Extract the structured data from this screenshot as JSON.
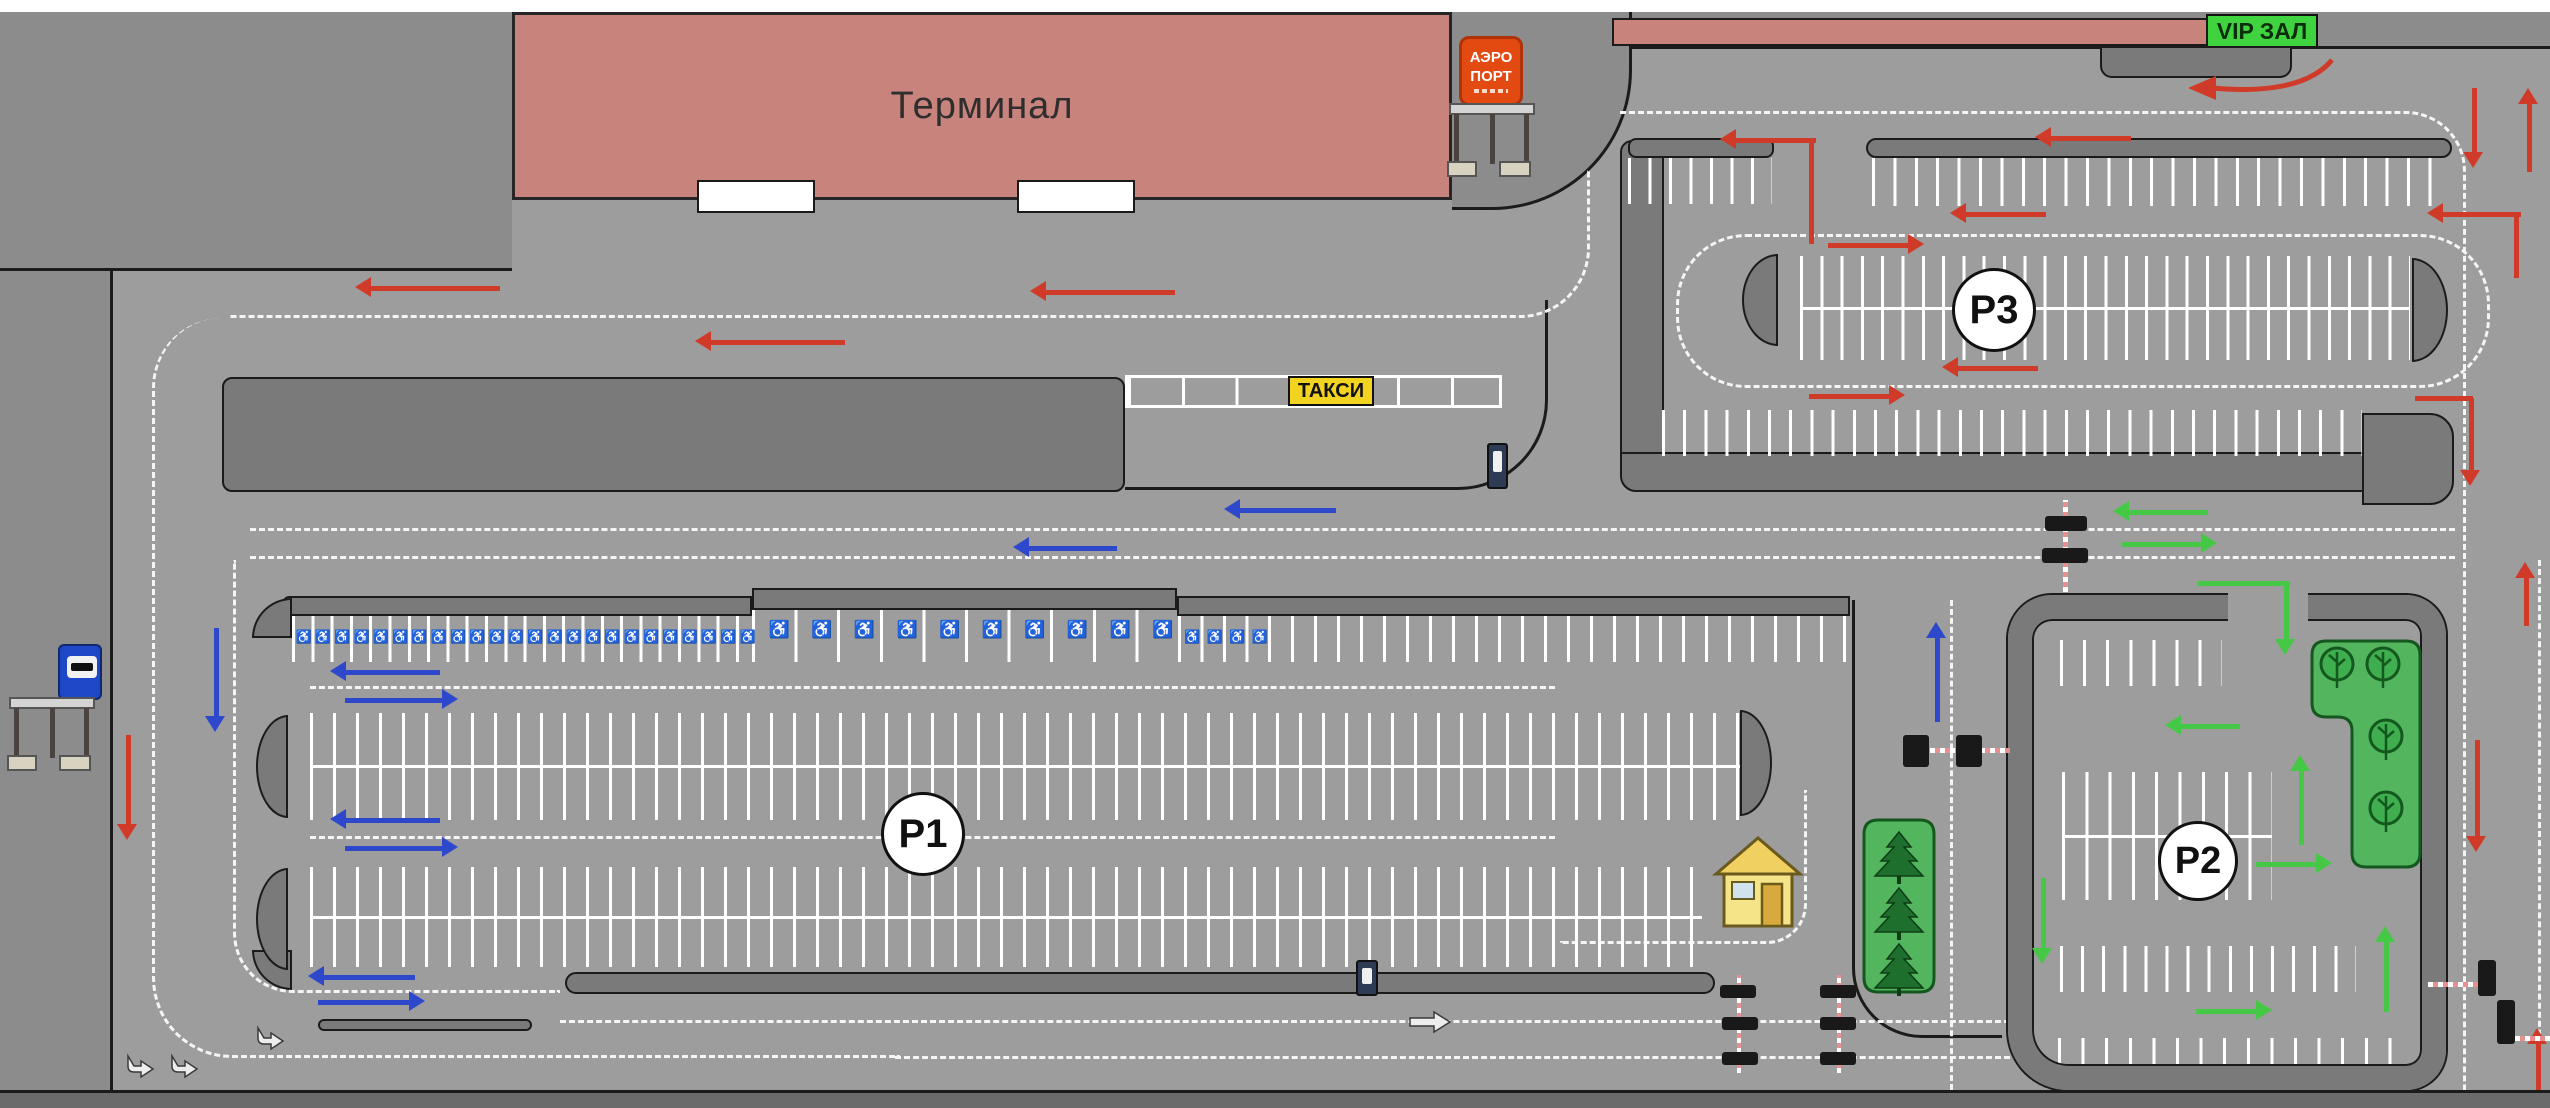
{
  "labels": {
    "terminal": "Терминал",
    "taxi": "ТАКСИ",
    "vip": "VIP ЗАЛ",
    "airport_line1": "АЭРО",
    "airport_line2": "ПОРТ",
    "p1": "P1",
    "p2": "P2",
    "p3": "P3"
  },
  "symbols": {
    "wheelchair": "♿"
  },
  "colors": {
    "pavement": "#9d9d9d",
    "margin": "#8c8c8c",
    "curb": "#7a7a7a",
    "band": "#6b6b6b",
    "white": "#ffffff",
    "building": "#c9837d",
    "vip_green": "#3fd43f",
    "sign_red": "#e34a12",
    "taxi_yellow": "#f2d31f",
    "island_green": "#53b65e",
    "tree_dark": "#1e6f2e",
    "red": "#cf3b28",
    "blue": "#2e48cc",
    "green": "#45c845",
    "black": "#1b1b1b",
    "mark": "#f5f5f5",
    "arm_pink": "#e89090",
    "kiosk_blue": "#2e3b55"
  },
  "map": {
    "rects": [
      {
        "n": "pavement-main",
        "x": 110,
        "y": 200,
        "w": 2440,
        "h": 890,
        "f": "pavement",
        "bd": "l"
      },
      {
        "n": "pavement-upper-right",
        "x": 1452,
        "y": 46,
        "w": 1098,
        "h": 166,
        "f": "pavement",
        "bd": "t"
      },
      {
        "n": "apron-top-left",
        "x": 0,
        "y": 12,
        "w": 512,
        "h": 259,
        "f": "margin",
        "bd": "b"
      },
      {
        "n": "margin-left",
        "x": 0,
        "y": 271,
        "w": 110,
        "h": 819,
        "f": "margin"
      },
      {
        "n": "band-bottom",
        "x": 0,
        "y": 1090,
        "w": 2550,
        "h": 18,
        "f": "band",
        "bd": "t"
      },
      {
        "n": "band-top-white",
        "x": 0,
        "y": 0,
        "w": 2550,
        "h": 12,
        "f": "white"
      },
      {
        "n": "sidewalk-terminal-right",
        "x": 1452,
        "y": 12,
        "w": 180,
        "h": 198,
        "f": "margin",
        "bd": "rb",
        "r": "0 0 140px 0"
      },
      {
        "n": "vip-building",
        "x": 1612,
        "y": 18,
        "w": 596,
        "h": 28,
        "f": "building",
        "bd": "a"
      },
      {
        "n": "vip-platform",
        "x": 2100,
        "y": 46,
        "w": 192,
        "h": 32,
        "f": "curb",
        "bd": "a",
        "r": "0 0 12px 12px"
      },
      {
        "n": "median-strip",
        "x": 222,
        "y": 377,
        "w": 903,
        "h": 115,
        "f": "curb",
        "bd": "a",
        "r": "10px"
      },
      {
        "n": "p1-curb-a",
        "x": 283,
        "y": 596,
        "w": 469,
        "h": 20,
        "f": "curb",
        "bd": "a",
        "r": "6px 0 0 6px"
      },
      {
        "n": "p1-curb-b",
        "x": 752,
        "y": 588,
        "w": 425,
        "h": 22,
        "f": "curb",
        "bd": "a"
      },
      {
        "n": "p1-curb-c",
        "x": 1177,
        "y": 596,
        "w": 673,
        "h": 20,
        "f": "curb",
        "bd": "a"
      },
      {
        "n": "p1-corner-top",
        "x": 252,
        "y": 598,
        "w": 40,
        "h": 40,
        "f": "curb",
        "bd": "a",
        "r": "100% 0 0 0"
      },
      {
        "n": "p1-corner-bottom",
        "x": 252,
        "y": 950,
        "w": 40,
        "h": 40,
        "f": "curb",
        "bd": "a",
        "r": "0 0 0 100%"
      },
      {
        "n": "p1-exit-strip-a",
        "x": 318,
        "y": 1019,
        "w": 214,
        "h": 12,
        "f": "curb",
        "bd": "a",
        "r": "7px"
      },
      {
        "n": "p1-exit-strip-b",
        "x": 565,
        "y": 972,
        "w": 1150,
        "h": 22,
        "f": "curb",
        "bd": "a",
        "r": "11px"
      },
      {
        "n": "p3-wall-left",
        "x": 1620,
        "y": 140,
        "w": 44,
        "h": 330,
        "f": "curb",
        "bd": "a",
        "r": "12px 0 0 12px"
      },
      {
        "n": "p3-wall-bottom",
        "x": 1620,
        "y": 452,
        "w": 766,
        "h": 40,
        "f": "curb",
        "bd": "a",
        "r": "0 0 0 16px"
      },
      {
        "n": "p3-corner-block",
        "x": 2362,
        "y": 413,
        "w": 92,
        "h": 92,
        "f": "curb",
        "bd": "a",
        "r": "0 24px 24px 0"
      },
      {
        "n": "p3-curb-a",
        "x": 1628,
        "y": 138,
        "w": 146,
        "h": 20,
        "f": "curb",
        "bd": "a",
        "r": "8px"
      },
      {
        "n": "p3-curb-b",
        "x": 1866,
        "y": 138,
        "w": 586,
        "h": 20,
        "f": "curb",
        "bd": "a",
        "r": "10px"
      },
      {
        "n": "terminal-door",
        "x": 697,
        "y": 180,
        "w": 118,
        "h": 33,
        "f": "white",
        "bd": "a"
      },
      {
        "n": "terminal-door",
        "x": 1017,
        "y": 180,
        "w": 118,
        "h": 33,
        "f": "white",
        "bd": "a"
      },
      {
        "n": "p2-wall",
        "x": 2008,
        "y": 595,
        "w": 438,
        "h": 495,
        "wall": 24,
        "r": "44px 40px 40px 60px"
      },
      {
        "n": "p2-entrance-gap",
        "x": 2228,
        "y": 591,
        "w": 80,
        "h": 34,
        "f": "pavement"
      }
    ],
    "lines": [
      {
        "n": "taxi-area-boundary",
        "x": 1125,
        "y": 300,
        "w": 423,
        "h": 190,
        "s": "rb",
        "r": "0 0 90px 0"
      },
      {
        "n": "p1-right-boundary",
        "x": 1852,
        "y": 600,
        "w": 150,
        "h": 438,
        "s": "lb",
        "r": "0 0 0 70px"
      }
    ],
    "dashes": [
      {
        "n": "loop-left",
        "x": 152,
        "y": 318,
        "w": 748,
        "h": 740,
        "s": "lb",
        "r": "70px 0 0 80px"
      },
      {
        "n": "loop-left-inner",
        "x": 233,
        "y": 560,
        "w": 327,
        "h": 433,
        "s": "lb",
        "r": "0 0 0 60px"
      },
      {
        "n": "terminal-road-lane",
        "x": 230,
        "y": 170,
        "w": 1360,
        "h": 148,
        "s": "rb",
        "r": "0 0 70px 0"
      },
      {
        "n": "connector-lane-1",
        "x": 250,
        "y": 528,
        "w": 2205,
        "h": 0,
        "s": "t"
      },
      {
        "n": "connector-lane-2",
        "x": 250,
        "y": 556,
        "w": 2205,
        "h": 0,
        "s": "t"
      },
      {
        "n": "vip-right-road-lane",
        "x": 1620,
        "y": 111,
        "w": 846,
        "h": 979,
        "s": "tr",
        "r": "0 60px 0 0"
      },
      {
        "n": "right-road-lane-2",
        "x": 2538,
        "y": 560,
        "w": 0,
        "h": 530,
        "s": "l"
      },
      {
        "n": "p1-aisle-1",
        "x": 310,
        "y": 686,
        "w": 1245,
        "h": 0,
        "s": "t"
      },
      {
        "n": "p1-aisle-2",
        "x": 310,
        "y": 836,
        "w": 1245,
        "h": 0,
        "s": "t"
      },
      {
        "n": "p1-exit-elbow",
        "x": 1560,
        "y": 790,
        "w": 247,
        "h": 154,
        "s": "rb",
        "r": "0 0 40px 0"
      },
      {
        "n": "bottom-lane-1",
        "x": 560,
        "y": 1020,
        "w": 1450,
        "h": 0,
        "s": "t"
      },
      {
        "n": "bottom-lane-2",
        "x": 895,
        "y": 1056,
        "w": 1115,
        "h": 0,
        "s": "t"
      },
      {
        "n": "vertical-road-lane",
        "x": 1950,
        "y": 600,
        "w": 0,
        "h": 490,
        "s": "l"
      },
      {
        "n": "p3-island-outline",
        "x": 1676,
        "y": 234,
        "w": 814,
        "h": 154,
        "s": "a",
        "r": "70px"
      }
    ],
    "combs": [
      {
        "n": "p1-disabled-stalls-narrow",
        "x": 292,
        "y": 616,
        "w": 462,
        "h": 46,
        "p": 19.3
      },
      {
        "n": "p1-disabled-stalls-wide",
        "x": 752,
        "y": 610,
        "w": 426,
        "h": 52,
        "p": 42.6
      },
      {
        "n": "p1-disabled-stalls-2",
        "x": 1178,
        "y": 616,
        "w": 90,
        "h": 46,
        "p": 22.5
      },
      {
        "n": "p1-top-stalls",
        "x": 1268,
        "y": 616,
        "w": 578,
        "h": 46,
        "p": 23
      },
      {
        "n": "p1-row1-stalls",
        "x": 310,
        "y": 713,
        "w": 1430,
        "h": 107,
        "p": 23,
        "c": 1
      },
      {
        "n": "p1-row2-stalls",
        "x": 310,
        "y": 867,
        "w": 1392,
        "h": 100,
        "p": 23,
        "c": 1
      },
      {
        "n": "taxi-bays",
        "x": 1125,
        "y": 375,
        "w": 377,
        "h": 33,
        "p": 53.8,
        "o": 1
      },
      {
        "n": "p3-upper-stalls-a",
        "x": 1628,
        "y": 158,
        "w": 144,
        "h": 46,
        "p": 20.5
      },
      {
        "n": "p3-upper-stalls-b",
        "x": 1872,
        "y": 158,
        "w": 578,
        "h": 48,
        "p": 21.4
      },
      {
        "n": "p3-island-stalls",
        "x": 1800,
        "y": 256,
        "w": 610,
        "h": 104,
        "p": 20.3,
        "c": 1
      },
      {
        "n": "p3-lower-stalls",
        "x": 1662,
        "y": 410,
        "w": 700,
        "h": 46,
        "p": 21.2
      },
      {
        "n": "p2-stalls-top",
        "x": 2060,
        "y": 640,
        "w": 162,
        "h": 46,
        "p": 23.1
      },
      {
        "n": "p2-stalls-mid",
        "x": 2062,
        "y": 772,
        "w": 210,
        "h": 128,
        "p": 23.3,
        "c": 1
      },
      {
        "n": "p2-stalls-3",
        "x": 2060,
        "y": 946,
        "w": 296,
        "h": 46,
        "p": 21.1
      },
      {
        "n": "p2-stalls-bottom",
        "x": 2058,
        "y": 1038,
        "w": 354,
        "h": 46,
        "p": 23.6
      }
    ],
    "caps": [
      {
        "n": "p1-row1-endcap-left",
        "x": 256,
        "y": 715,
        "w": 32,
        "h": 103,
        "s": "l"
      },
      {
        "n": "p1-row1-endcap-right",
        "x": 1740,
        "y": 710,
        "w": 32,
        "h": 106,
        "s": "r"
      },
      {
        "n": "p1-row2-endcap-left",
        "x": 256,
        "y": 868,
        "w": 32,
        "h": 102,
        "s": "l"
      },
      {
        "n": "p3-endcap-left",
        "x": 1742,
        "y": 254,
        "w": 36,
        "h": 92,
        "s": "l"
      },
      {
        "n": "p3-endcap-right",
        "x": 2412,
        "y": 258,
        "w": 36,
        "h": 104,
        "s": "r"
      }
    ],
    "wheel_rows": [
      {
        "x": 294,
        "y": 629,
        "n": 24,
        "p": 19.3,
        "s": 13
      },
      {
        "x": 758,
        "y": 620,
        "n": 10,
        "p": 42.6,
        "s": 17
      },
      {
        "x": 1181,
        "y": 629,
        "n": 4,
        "p": 22.5,
        "s": 13
      }
    ],
    "arrows": [
      {
        "n": "traffic-arrow-red",
        "x": 355,
        "y": 288,
        "l": 145,
        "d": "l",
        "c": "red"
      },
      {
        "n": "traffic-arrow-red",
        "x": 1030,
        "y": 292,
        "l": 145,
        "d": "l",
        "c": "red"
      },
      {
        "n": "traffic-arrow-red",
        "x": 695,
        "y": 342,
        "l": 150,
        "d": "l",
        "c": "red"
      },
      {
        "n": "traffic-arrow-red",
        "x": 1720,
        "y": 140,
        "l": 96,
        "d": "l",
        "c": "red"
      },
      {
        "n": "traffic-arrow-red",
        "x": 2035,
        "y": 138,
        "l": 96,
        "d": "l",
        "c": "red"
      },
      {
        "n": "traffic-arrow-red",
        "x": 1950,
        "y": 214,
        "l": 96,
        "d": "l",
        "c": "red"
      },
      {
        "n": "traffic-arrow-red",
        "x": 1828,
        "y": 245,
        "l": 96,
        "d": "r",
        "c": "red"
      },
      {
        "n": "traffic-arrow-red",
        "x": 1942,
        "y": 368,
        "l": 96,
        "d": "l",
        "c": "red"
      },
      {
        "n": "traffic-arrow-red",
        "x": 1809,
        "y": 396,
        "l": 96,
        "d": "r",
        "c": "red"
      },
      {
        "n": "traffic-arrow-red",
        "x": 2427,
        "y": 214,
        "l": 94,
        "d": "l",
        "c": "red"
      },
      {
        "n": "traffic-arrow-red",
        "x": 2471,
        "y": 398,
        "l": 88,
        "d": "d",
        "c": "red"
      },
      {
        "n": "traffic-arrow-red",
        "x": 2474,
        "y": 88,
        "l": 80,
        "d": "d",
        "c": "red"
      },
      {
        "n": "traffic-arrow-red",
        "x": 2529,
        "y": 88,
        "l": 84,
        "d": "u",
        "c": "red"
      },
      {
        "n": "traffic-arrow-red",
        "x": 2526,
        "y": 562,
        "l": 64,
        "d": "u",
        "c": "red"
      },
      {
        "n": "traffic-arrow-red",
        "x": 2477,
        "y": 740,
        "l": 112,
        "d": "d",
        "c": "red"
      },
      {
        "n": "traffic-arrow-red",
        "x": 2538,
        "y": 1028,
        "l": 62,
        "d": "u",
        "c": "red"
      },
      {
        "n": "traffic-arrow-red",
        "x": 128,
        "y": 735,
        "l": 105,
        "d": "d",
        "c": "red"
      },
      {
        "n": "traffic-arrow-blue",
        "x": 216,
        "y": 628,
        "l": 104,
        "d": "d",
        "c": "blue"
      },
      {
        "n": "traffic-arrow-blue",
        "x": 1224,
        "y": 510,
        "l": 112,
        "d": "l",
        "c": "blue"
      },
      {
        "n": "traffic-arrow-blue",
        "x": 1013,
        "y": 548,
        "l": 104,
        "d": "l",
        "c": "blue"
      },
      {
        "n": "traffic-arrow-blue",
        "x": 330,
        "y": 672,
        "l": 110,
        "d": "l",
        "c": "blue"
      },
      {
        "n": "traffic-arrow-blue",
        "x": 345,
        "y": 700,
        "l": 113,
        "d": "r",
        "c": "blue"
      },
      {
        "n": "traffic-arrow-blue",
        "x": 330,
        "y": 820,
        "l": 110,
        "d": "l",
        "c": "blue"
      },
      {
        "n": "traffic-arrow-blue",
        "x": 345,
        "y": 848,
        "l": 113,
        "d": "r",
        "c": "blue"
      },
      {
        "n": "traffic-arrow-blue",
        "x": 308,
        "y": 977,
        "l": 107,
        "d": "l",
        "c": "blue"
      },
      {
        "n": "traffic-arrow-blue",
        "x": 318,
        "y": 1002,
        "l": 107,
        "d": "r",
        "c": "blue"
      },
      {
        "n": "traffic-arrow-blue",
        "x": 1937,
        "y": 622,
        "l": 100,
        "d": "u",
        "c": "blue"
      },
      {
        "n": "traffic-arrow-green",
        "x": 2113,
        "y": 512,
        "l": 95,
        "d": "l",
        "c": "green"
      },
      {
        "n": "traffic-arrow-green",
        "x": 2122,
        "y": 544,
        "l": 95,
        "d": "r",
        "c": "green"
      },
      {
        "n": "traffic-arrow-green",
        "x": 2286,
        "y": 583,
        "l": 72,
        "d": "d",
        "c": "green"
      },
      {
        "n": "traffic-arrow-green",
        "x": 2165,
        "y": 726,
        "l": 75,
        "d": "l",
        "c": "green"
      },
      {
        "n": "traffic-arrow-green",
        "x": 2301,
        "y": 755,
        "l": 90,
        "d": "u",
        "c": "green"
      },
      {
        "n": "traffic-arrow-green",
        "x": 2256,
        "y": 864,
        "l": 76,
        "d": "r",
        "c": "green"
      },
      {
        "n": "traffic-arrow-green",
        "x": 2043,
        "y": 878,
        "l": 86,
        "d": "d",
        "c": "green"
      },
      {
        "n": "traffic-arrow-green",
        "x": 2386,
        "y": 926,
        "l": 86,
        "d": "u",
        "c": "green"
      },
      {
        "n": "traffic-arrow-green",
        "x": 2196,
        "y": 1011,
        "l": 76,
        "d": "r",
        "c": "green"
      }
    ],
    "color_lines": [
      {
        "n": "arrow-tail",
        "x": 1809,
        "y": 142,
        "w": 5,
        "h": 102,
        "c": "red"
      },
      {
        "n": "arrow-tail",
        "x": 2514,
        "y": 216,
        "w": 5,
        "h": 62,
        "c": "red"
      },
      {
        "n": "arrow-tail",
        "x": 2415,
        "y": 396,
        "w": 58,
        "h": 5,
        "c": "red"
      },
      {
        "n": "arrow-tail",
        "x": 2198,
        "y": 581,
        "w": 92,
        "h": 5,
        "c": "green"
      }
    ],
    "barrier_boxes": [
      {
        "x": 2045,
        "y": 516,
        "w": 42,
        "h": 15
      },
      {
        "x": 2042,
        "y": 548,
        "w": 46,
        "h": 15
      },
      {
        "x": 1903,
        "y": 735,
        "w": 26,
        "h": 32
      },
      {
        "x": 1956,
        "y": 735,
        "w": 26,
        "h": 32
      },
      {
        "x": 1720,
        "y": 985,
        "w": 36,
        "h": 13
      },
      {
        "x": 1820,
        "y": 985,
        "w": 36,
        "h": 13
      },
      {
        "x": 1722,
        "y": 1017,
        "w": 36,
        "h": 13
      },
      {
        "x": 1820,
        "y": 1017,
        "w": 36,
        "h": 13
      },
      {
        "x": 1722,
        "y": 1052,
        "w": 36,
        "h": 13
      },
      {
        "x": 1820,
        "y": 1052,
        "w": 36,
        "h": 13
      },
      {
        "x": 2478,
        "y": 960,
        "w": 18,
        "h": 36
      },
      {
        "x": 2497,
        "y": 1000,
        "w": 18,
        "h": 44
      }
    ],
    "barrier_arms": [
      {
        "x": 2063,
        "y": 500,
        "w": 5,
        "h": 92,
        "v": 1
      },
      {
        "x": 1930,
        "y": 748,
        "w": 80,
        "h": 5
      },
      {
        "x": 1737,
        "y": 975,
        "w": 4,
        "h": 98,
        "v": 1
      },
      {
        "x": 1837,
        "y": 975,
        "w": 4,
        "h": 98,
        "v": 1
      },
      {
        "x": 2428,
        "y": 982,
        "w": 50,
        "h": 5
      },
      {
        "x": 2515,
        "y": 1036,
        "w": 38,
        "h": 5
      }
    ],
    "kiosks": [
      {
        "x": 1487,
        "y": 443,
        "w": 21,
        "h": 46
      },
      {
        "x": 1356,
        "y": 960,
        "w": 22,
        "h": 36
      }
    ],
    "icons": [
      {
        "t": "pine-island",
        "x": 1864,
        "y": 820,
        "w": 70,
        "h": 172
      },
      {
        "t": "pine",
        "x": 1899,
        "y": 832
      },
      {
        "t": "pine",
        "x": 1899,
        "y": 888
      },
      {
        "t": "pine",
        "x": 1899,
        "y": 944
      },
      {
        "t": "leaf-island"
      },
      {
        "t": "leaf",
        "x": 2337,
        "y": 664
      },
      {
        "t": "leaf",
        "x": 2383,
        "y": 664
      },
      {
        "t": "leaf",
        "x": 2386,
        "y": 736
      },
      {
        "t": "leaf",
        "x": 2386,
        "y": 808
      },
      {
        "t": "house",
        "x": 1718,
        "y": 838
      },
      {
        "t": "shelter",
        "x": 10,
        "y": 698
      },
      {
        "t": "shelter",
        "x": 1450,
        "y": 104
      },
      {
        "t": "curve-arrow"
      },
      {
        "t": "straight-arrow",
        "x": 1410,
        "y": 1014
      },
      {
        "t": "turn-arrow",
        "x": 128,
        "y": 1056
      },
      {
        "t": "turn-arrow",
        "x": 172,
        "y": 1056
      },
      {
        "t": "turn-arrow",
        "x": 258,
        "y": 1028
      }
    ]
  }
}
